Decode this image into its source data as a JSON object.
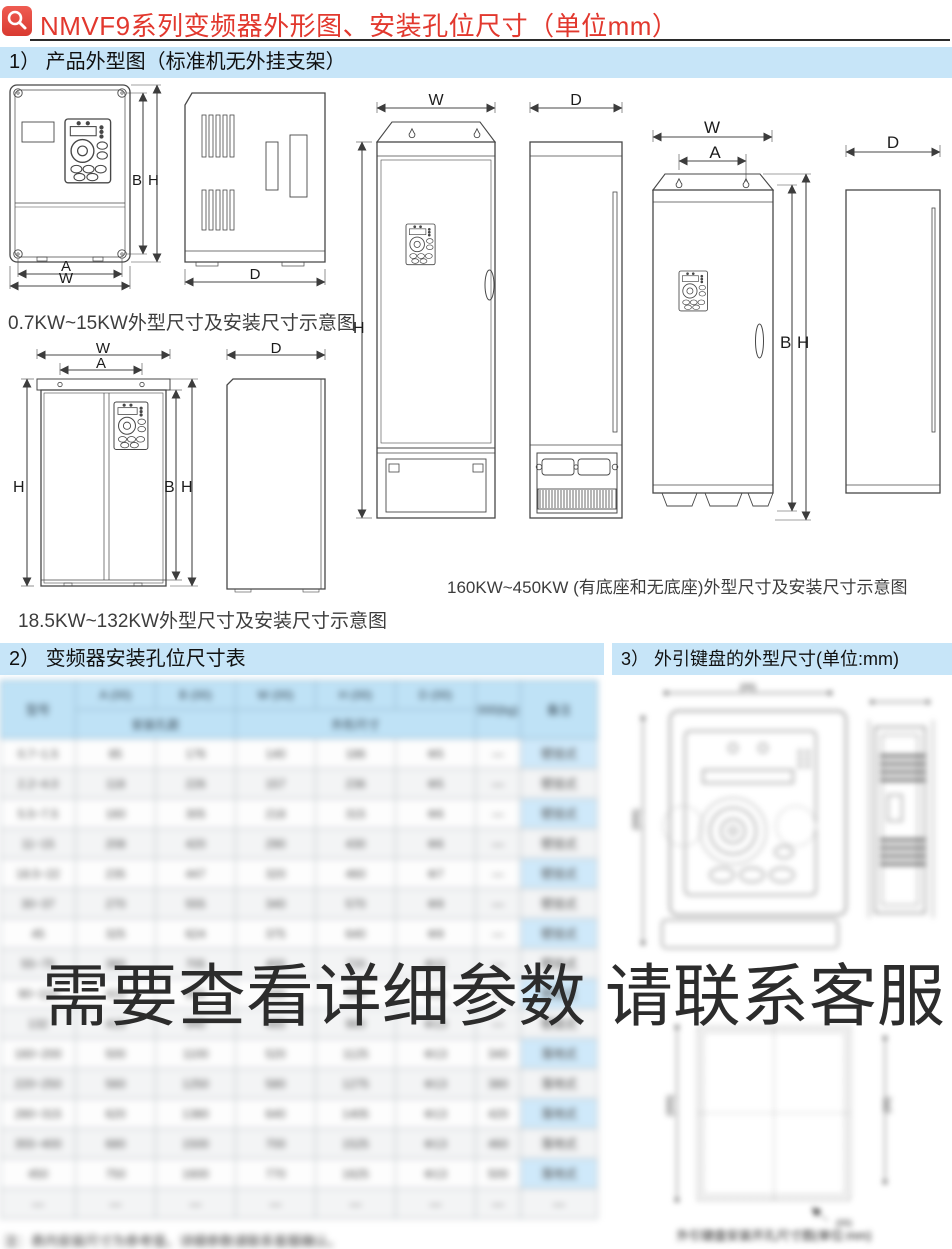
{
  "header": {
    "title": "NMVF9系列变频器外形图、安装孔位尺寸（单位mm）"
  },
  "sections": {
    "s1_label": "1） 产品外型图（标准机无外挂支架）",
    "s2_label": "2） 变频器安装孔位尺寸表",
    "s3_label": "3） 外引键盘的外型尺寸(单位:mm)"
  },
  "captions": {
    "small": "0.7KW~15KW外型尺寸及安装尺寸示意图",
    "mid": "18.5KW~132KW外型尺寸及安装尺寸示意图",
    "large": "160KW~450KW (有底座和无底座)外型尺寸及安装尺寸示意图"
  },
  "dims": {
    "W": "W",
    "A": "A",
    "B": "B",
    "H": "H",
    "D": "D"
  },
  "watermark": "需要查看详细参数 请联系客服",
  "colors": {
    "accent_red": "#e2382e",
    "banner_blue": "#c7e5f8",
    "table_header_blue": "#bfe2f6",
    "watermark_gray": "#2c2c2c"
  },
  "blurred_table": {
    "header1": [
      [
        "型号",
        1,
        2
      ],
      [
        "A (00)"
      ],
      [
        "B (00)"
      ],
      [
        "W (00)"
      ],
      [
        "H (00)"
      ],
      [
        "D (00)"
      ],
      [
        "000(kg)",
        1,
        2
      ],
      [
        "备注",
        1,
        2
      ]
    ],
    "header2": [
      [
        "安装孔距",
        2,
        1
      ],
      [
        "外形尺寸",
        3,
        1
      ]
    ],
    "rows": [
      [
        "0.7~1.5",
        "85",
        "176",
        "140",
        "186",
        "Φ5",
        "—",
        "壁挂式"
      ],
      [
        "2.2~4.0",
        "118",
        "226",
        "157",
        "236",
        "Φ5",
        "—",
        "壁挂式"
      ],
      [
        "5.5~7.5",
        "160",
        "305",
        "218",
        "315",
        "Φ6",
        "—",
        "壁挂式"
      ],
      [
        "11~15",
        "208",
        "420",
        "290",
        "430",
        "Φ6",
        "—",
        "壁挂式"
      ],
      [
        "18.5~22",
        "235",
        "447",
        "320",
        "460",
        "Φ7",
        "—",
        "壁挂式"
      ],
      [
        "30~37",
        "270",
        "555",
        "340",
        "570",
        "Φ9",
        "—",
        "壁挂式"
      ],
      [
        "45",
        "325",
        "624",
        "375",
        "640",
        "Φ9",
        "—",
        "壁挂式"
      ],
      [
        "55~75",
        "360",
        "705",
        "400",
        "720",
        "Φ11",
        "—",
        "壁挂式"
      ],
      [
        "90~110",
        "410",
        "855",
        "440",
        "880",
        "Φ11",
        "—",
        "壁挂式"
      ],
      [
        "132",
        "415",
        "940",
        "465",
        "960",
        "Φ13",
        "—",
        "壁挂式"
      ],
      [
        "160~200",
        "500",
        "1100",
        "520",
        "1125",
        "Φ13",
        "340",
        "落地式"
      ],
      [
        "220~250",
        "560",
        "1250",
        "580",
        "1275",
        "Φ13",
        "380",
        "落地式"
      ],
      [
        "280~315",
        "620",
        "1380",
        "640",
        "1405",
        "Φ13",
        "420",
        "落地式"
      ],
      [
        "355~400",
        "680",
        "1500",
        "700",
        "1525",
        "Φ13",
        "460",
        "落地式"
      ],
      [
        "450",
        "750",
        "1600",
        "770",
        "1625",
        "Φ13",
        "500",
        "落地式"
      ],
      [
        "—",
        "—",
        "—",
        "—",
        "—",
        "—",
        "—",
        "—"
      ]
    ]
  },
  "blurred_notes": {
    "footnote": "注：表内安装尺寸为参考值，详细参数请联系客服确认。",
    "keypad_caption": "外引键盘安装开孔尺寸图(单位:mm)",
    "kd1": "(00)",
    "kd2": "(000)"
  }
}
